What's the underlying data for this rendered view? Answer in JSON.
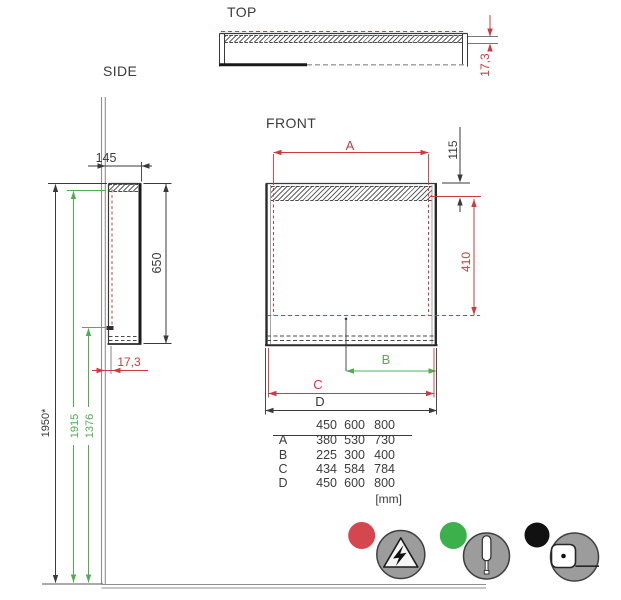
{
  "views": {
    "top_label": "TOP",
    "side_label": "SIDE",
    "front_label": "FRONT"
  },
  "dimensions": {
    "top_lamp_depth": "17,3",
    "side_depth": "145",
    "side_height": "650",
    "side_lamp_depth": "17,3",
    "height_total": "1950*",
    "height_upper": "1915",
    "height_lower": "1376",
    "label_a": "A",
    "lamp_height": "115",
    "mirror_height": "410",
    "label_b": "B",
    "label_c": "C",
    "label_d": "D"
  },
  "size_table": {
    "header": [
      "450",
      "600",
      "800"
    ],
    "rows": [
      {
        "label": "A",
        "values": [
          "380",
          "530",
          "730"
        ]
      },
      {
        "label": "B",
        "values": [
          "225",
          "300",
          "400"
        ]
      },
      {
        "label": "C",
        "values": [
          "434",
          "584",
          "784"
        ]
      },
      {
        "label": "D",
        "values": [
          "450",
          "600",
          "800"
        ]
      }
    ],
    "unit": "[mm]"
  },
  "legend": {
    "items": [
      {
        "dot_color": "#d5464e",
        "icon": "electrical-hazard"
      },
      {
        "dot_color": "#3cb14b",
        "icon": "screwdriver"
      },
      {
        "dot_color": "#111111",
        "icon": "tape-measure"
      }
    ]
  },
  "colors": {
    "dimension_red": "#cf3a40",
    "dimension_green": "#4cb050",
    "line_dark": "#3a3a3a",
    "icon_gray": "#9c9c9c"
  }
}
